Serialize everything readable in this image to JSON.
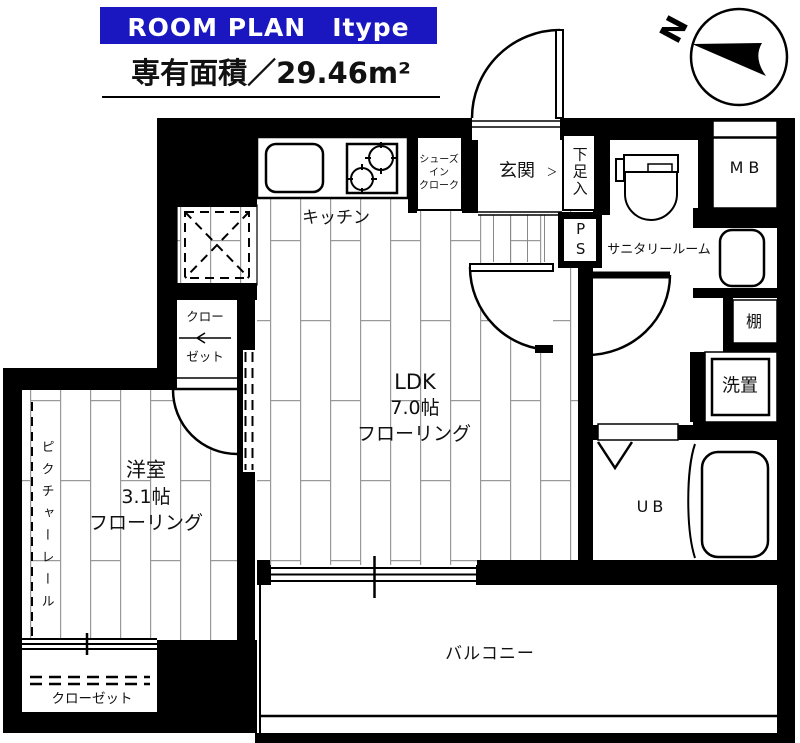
{
  "header": {
    "title": "ROOM PLAN　Itype",
    "area_label": "専有面積／29.46m²"
  },
  "compass": {
    "north": "N"
  },
  "colors": {
    "accent_blue": "#1a16c0",
    "wall_black": "#000000",
    "floor_line_gray": "#999999"
  },
  "rooms": {
    "kitchen": "キッチン",
    "shoe_cloak_lines": [
      "シューズ",
      "イン",
      "クローク"
    ],
    "entrance": "玄関",
    "entrance_arrow": "＞",
    "shoe_box": "下足入",
    "pipe_space": "PS",
    "sanitary": "サニタリールーム",
    "meter_box": "MB",
    "shelf": "棚",
    "laundry": "洗置",
    "unit_bath": "UB",
    "ldk": {
      "name": "LDK",
      "size": "7.0帖",
      "floor": "フローリング"
    },
    "western": {
      "name": "洋室",
      "size": "3.1帖",
      "floor": "フローリング"
    },
    "closet_upper_lines": [
      "クロー",
      "ゼット"
    ],
    "closet_lower": "クローゼット",
    "balcony": "バルコニー",
    "picture_rail": "ピクチャーレール"
  }
}
